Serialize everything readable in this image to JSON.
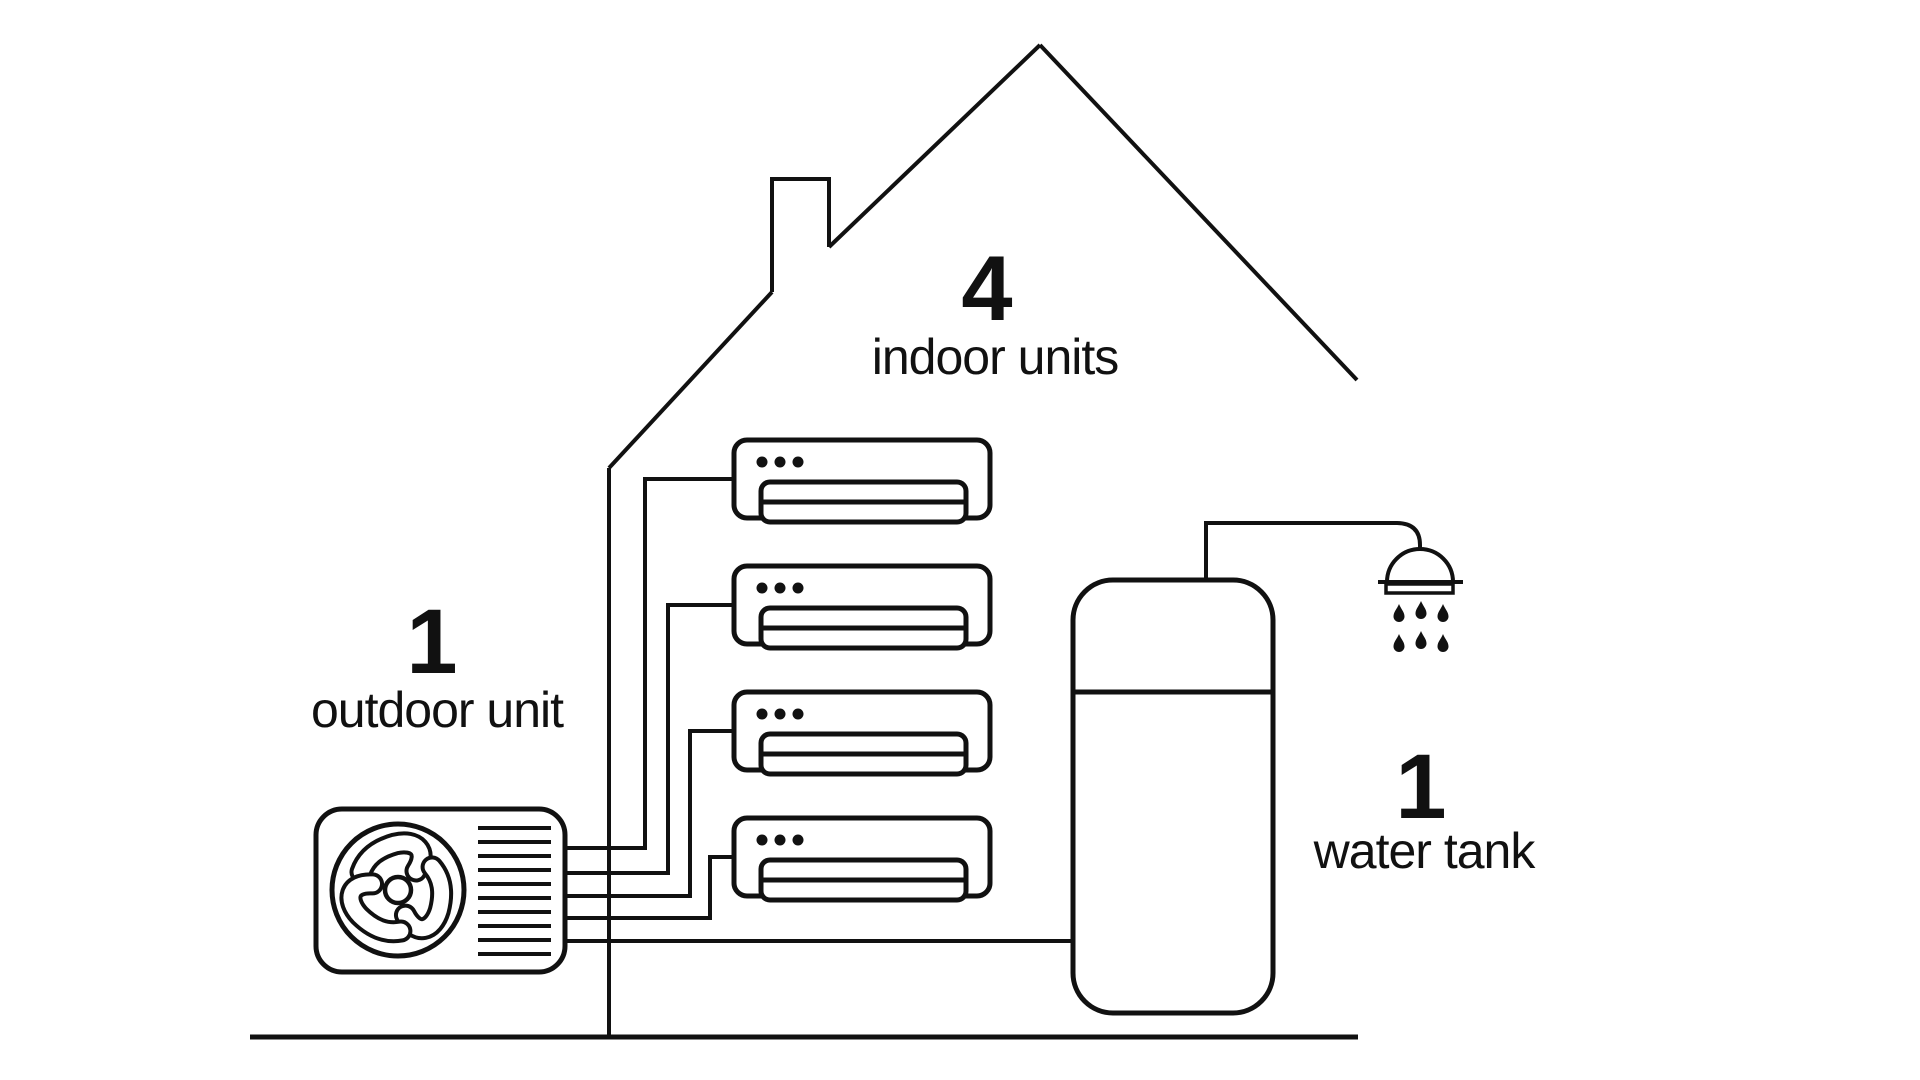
{
  "figure_type": "diagram",
  "colors": {
    "background": "#ffffff",
    "line": "#111111",
    "text": "#111111"
  },
  "labels": {
    "indoor_units": {
      "count": "4",
      "name": "indoor units"
    },
    "outdoor_unit": {
      "count": "1",
      "name": "outdoor unit"
    },
    "water_tank": {
      "count": "1",
      "name": "water tank"
    }
  },
  "components": {
    "indoor_unit_count": 4,
    "outdoor_unit_count": 1,
    "water_tank_count": 1,
    "shower_water_drop_count": 6
  }
}
